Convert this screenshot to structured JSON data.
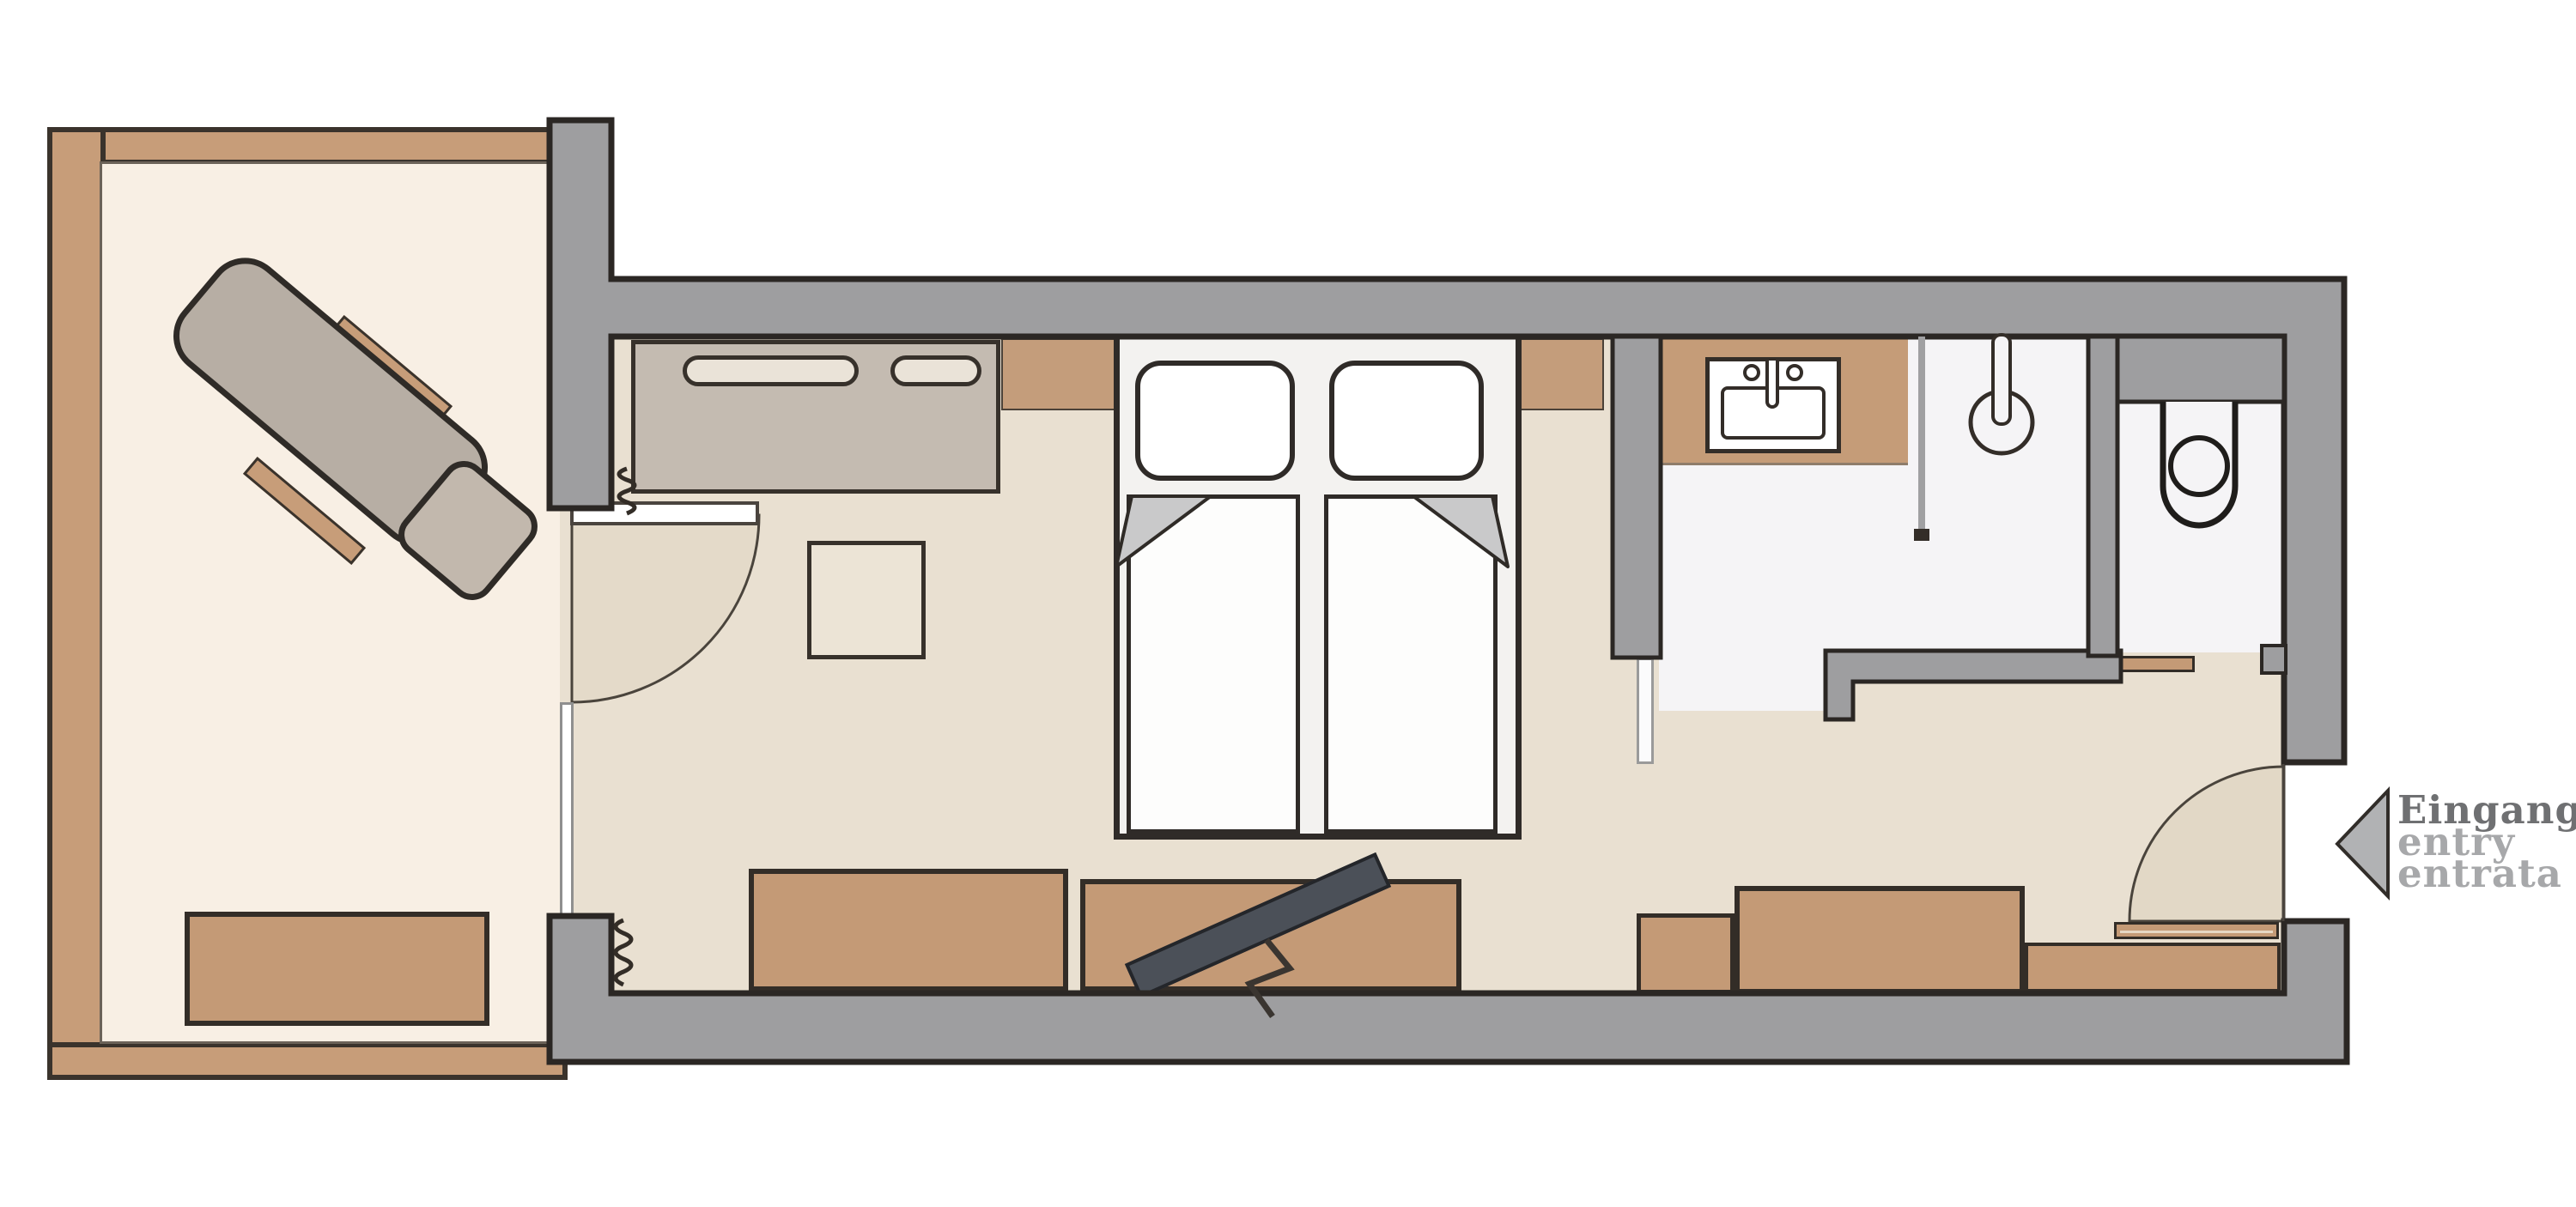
{
  "entrance": {
    "lines": [
      "Eingang",
      "entry",
      "entrata"
    ],
    "arrow_icon": "entry-direction-arrow-left"
  },
  "palette": {
    "wall_gray": "#9e9ea0",
    "outline_dark": "#2b2724",
    "wood_tan": "#c49a76",
    "balcony_frame_tan": "#c79d79",
    "floor_beige": "#e9e0d1",
    "bathroom_floor_white": "#f5f4f6",
    "balcony_floor_cream": "#f8efe4",
    "furniture_taupe": "#c4bbb1",
    "lounger_taupe": "#b7aea4",
    "door_swing_fill": "#e4dac9",
    "tv_dark": "#4b5058",
    "label_dark": "#6f7072",
    "label_light": "#a7a8aa"
  },
  "symbols": [
    "lounger-icon",
    "side-table-icon",
    "balcony-bench-icon",
    "curtain-coil-icon",
    "wardrobe-icon",
    "desk-icon",
    "double-bed-icon",
    "pillow-icon",
    "duvet-icon",
    "sideboard-icon",
    "tv-icon",
    "tv-cable-icon",
    "washbasin-icon",
    "shower-icon",
    "glass-partition-icon",
    "toilet-icon",
    "door-swing-arc-icon",
    "entry-arrow-icon"
  ]
}
